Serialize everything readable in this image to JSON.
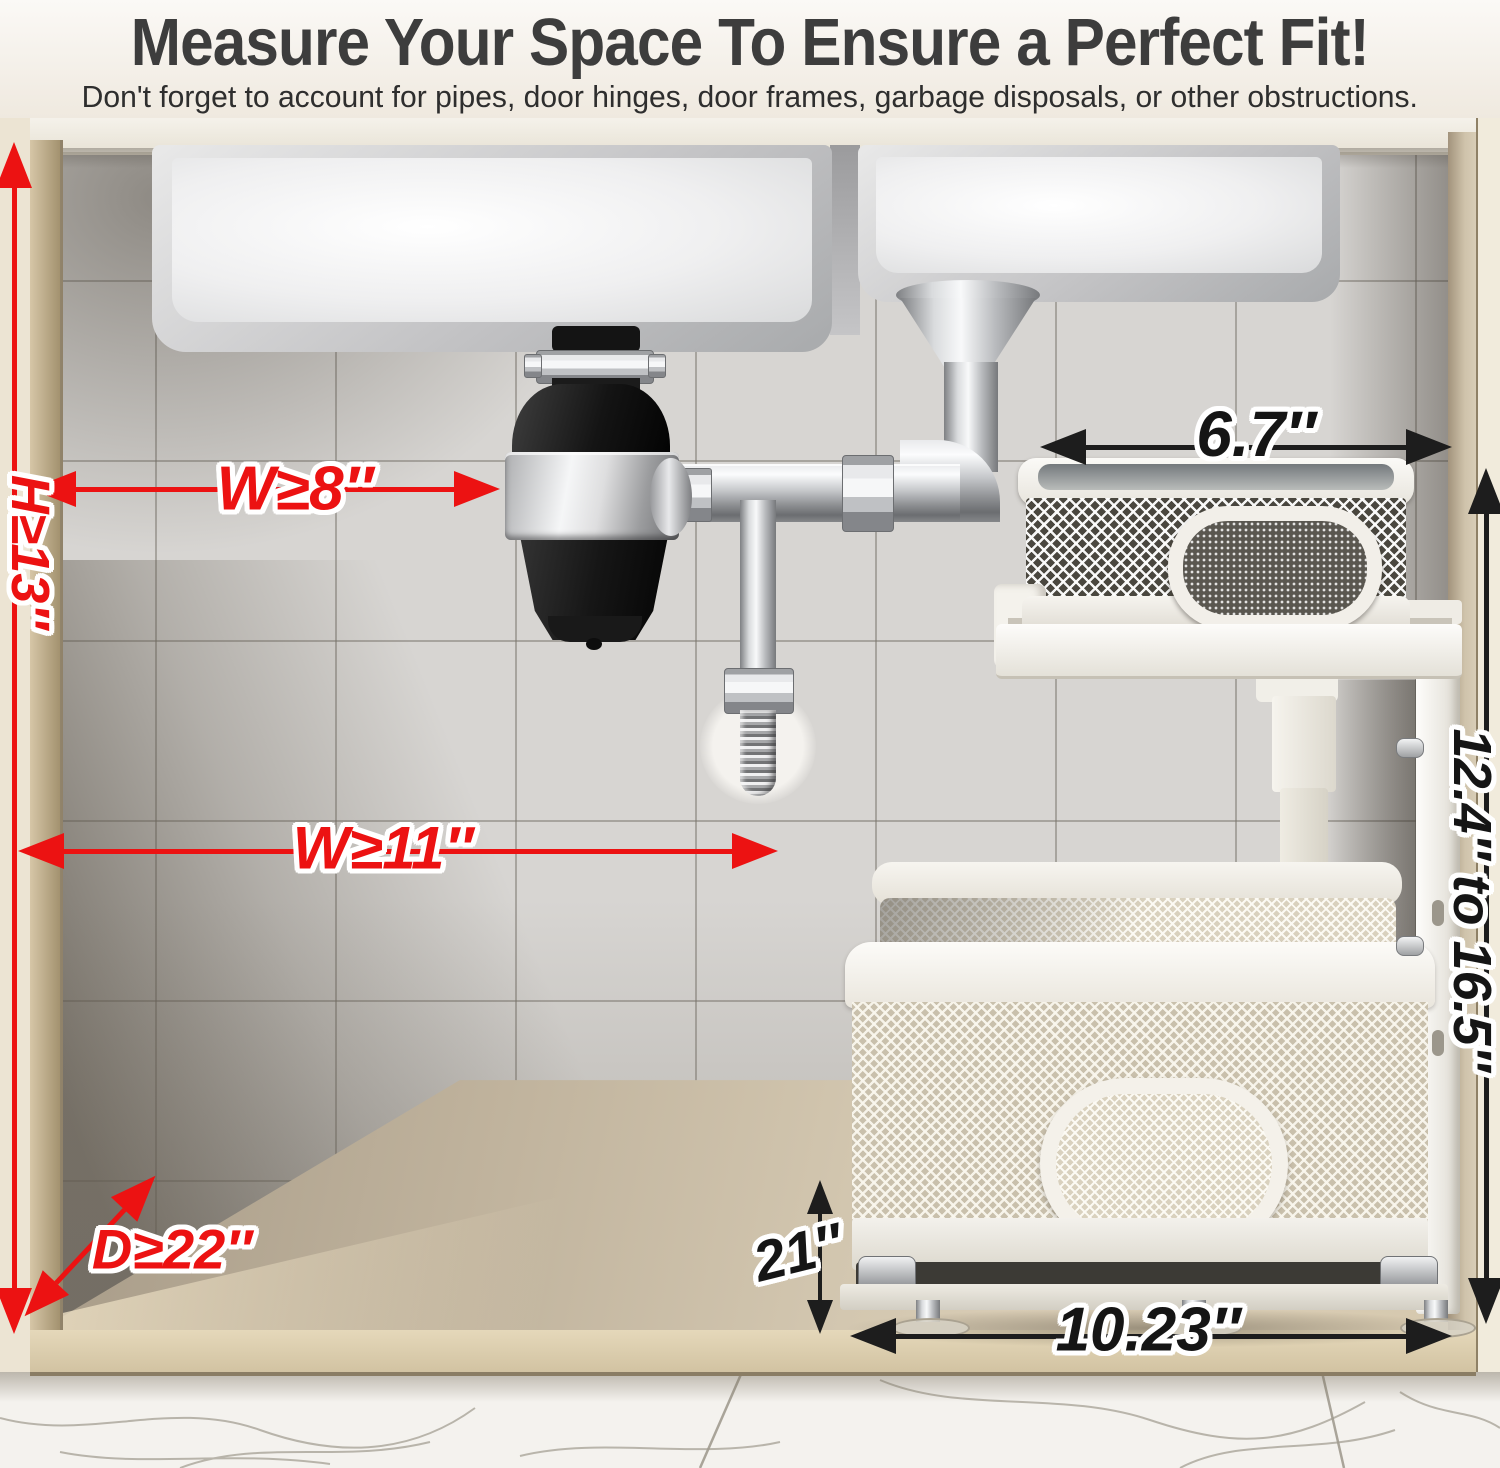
{
  "header": {
    "title": "Measure Your Space To Ensure a Perfect Fit!",
    "subtitle": "Don't forget to account for pipes, door hinges, door frames, garbage disposals, or other obstructions."
  },
  "measurements": {
    "cabinet_height": "H≥13″",
    "disposal_clearance_width": "W≥8″",
    "cabinet_width": "W≥11″",
    "cabinet_depth": "D≥22″",
    "top_basket_width": "6.7″",
    "adjustable_height_range": "12.4″ to 16.5″",
    "bottom_tier_height": "21″",
    "bottom_basket_width": "10.23″"
  },
  "colors": {
    "red_annotation": "#ec1212",
    "black_annotation": "#1d1d1d",
    "title_text": "#3d3d3d"
  }
}
